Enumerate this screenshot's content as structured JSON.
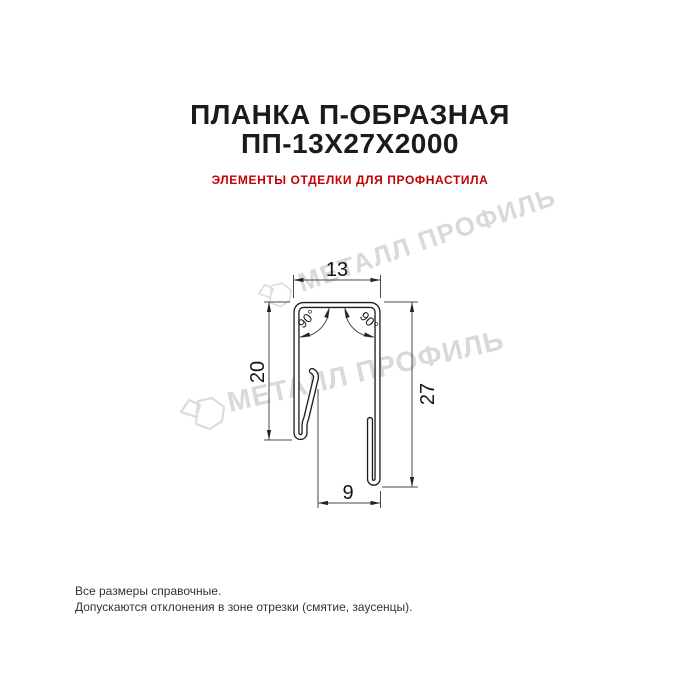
{
  "header": {
    "title_line1": "ПЛАНКА П-ОБРАЗНАЯ",
    "title_line2": "ПП-13Х27Х2000",
    "subtitle": "ЭЛЕМЕНТЫ ОТДЕЛКИ ДЛЯ ПРОФНАСТИЛА"
  },
  "drawing": {
    "type": "u-profile-cross-section",
    "dim_top_width": "13",
    "dim_left_height": "20",
    "dim_right_height": "27",
    "dim_bottom_width": "9",
    "angle_top_left": "90°",
    "angle_top_right": "90°"
  },
  "watermark": {
    "text": "МЕТАЛЛ ПРОФИЛЬ",
    "color": "#d9d9d9"
  },
  "footer": {
    "line1": "Все размеры справочные.",
    "line2": "Допускаются отклонения в зоне отрезки (смятие, заусенцы)."
  },
  "colors": {
    "subtitle_red": "#c40000",
    "profile_line": "#1a1a1a",
    "dimension_line": "#4a4a4a",
    "background": "#ffffff"
  }
}
